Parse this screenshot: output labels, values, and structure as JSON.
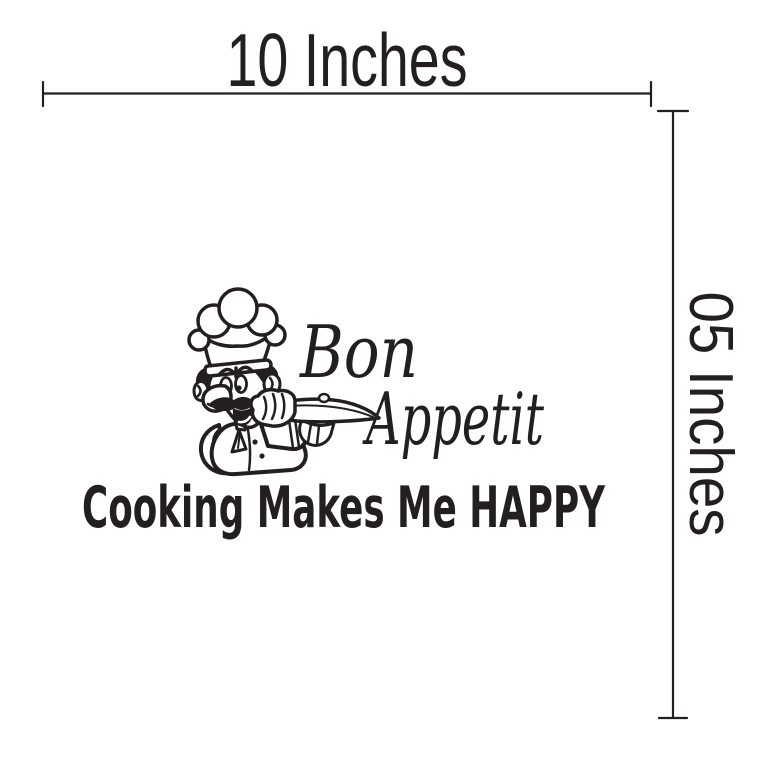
{
  "dimensions": {
    "width_label": "10 Inches",
    "height_label": "05 Inches"
  },
  "decal": {
    "script_line1": "Bon",
    "script_line2": "Appetit",
    "tagline": "Cooking Makes Me HAPPY",
    "illustration": "chef-with-serving-tray"
  },
  "colors": {
    "ink": "#231f20",
    "background": "#ffffff"
  }
}
